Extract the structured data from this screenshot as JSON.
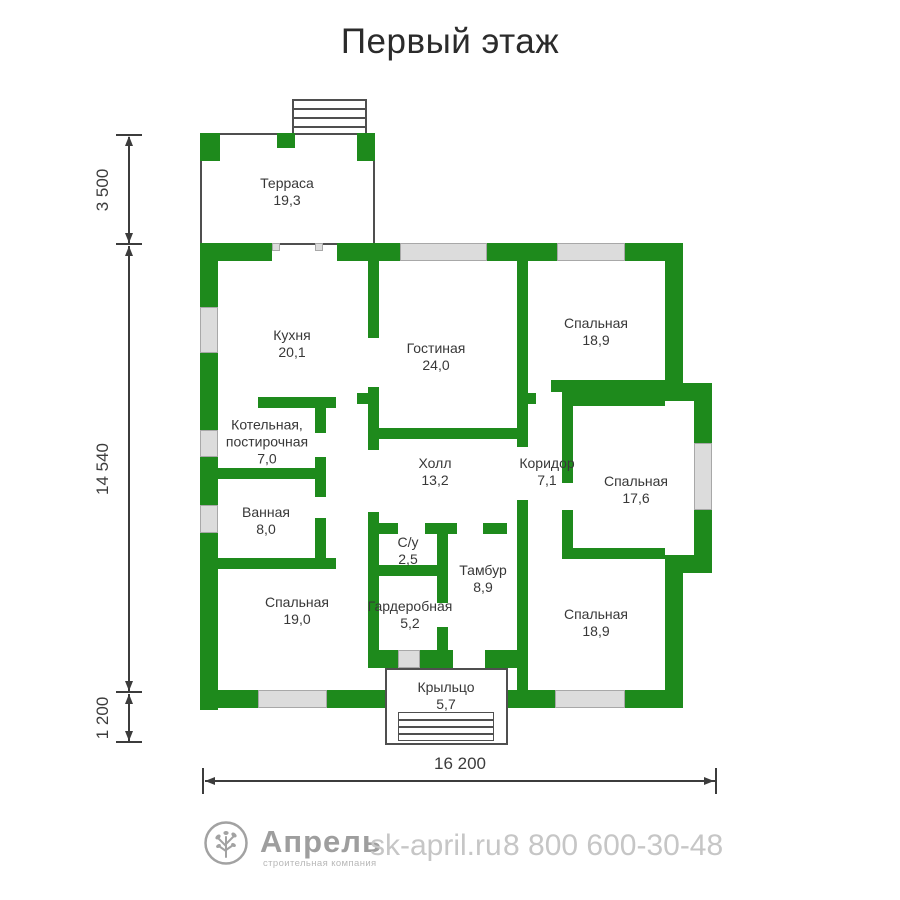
{
  "title": "Первый этаж",
  "rooms": [
    {
      "line1": "Терраса",
      "area": "19,3"
    },
    {
      "line1": "Кухня",
      "area": "20,1"
    },
    {
      "line1": "Гостиная",
      "area": "24,0"
    },
    {
      "line1": "Спальная",
      "area": "18,9"
    },
    {
      "line1": "Котельная,",
      "line2": "постирочная",
      "area": "7,0"
    },
    {
      "line1": "Холл",
      "area": "13,2"
    },
    {
      "line1": "Коридор",
      "area": "7,1"
    },
    {
      "line1": "Спальная",
      "area": "17,6"
    },
    {
      "line1": "Ванная",
      "area": "8,0"
    },
    {
      "line1": "С/у",
      "area": "2,5"
    },
    {
      "line1": "Тамбур",
      "area": "8,9"
    },
    {
      "line1": "Спальная",
      "area": "19,0"
    },
    {
      "line1": "Гардеробная",
      "area": "5,2"
    },
    {
      "line1": "Спальная",
      "area": "18,9"
    },
    {
      "line1": "Крыльцо",
      "area": "5,7"
    }
  ],
  "dims": {
    "left": [
      {
        "value": "3 500"
      },
      {
        "value": "14 540"
      },
      {
        "value": "1 200"
      }
    ],
    "bottom": {
      "value": "16 200"
    }
  },
  "footer": {
    "brand": "Апрель",
    "tagline": "строительная компания",
    "website": "sk-april.ru",
    "phone": "8 800 600-30-48",
    "logo_icon": "tree-icon"
  },
  "colors": {
    "wall": "#1e8a1c",
    "window": "#dcdcdc"
  }
}
